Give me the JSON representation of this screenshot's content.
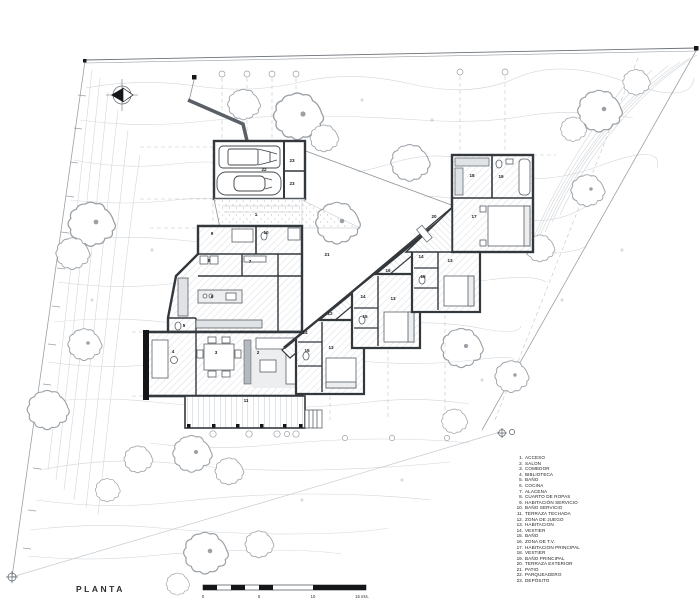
{
  "title": {
    "text": "PLANTA"
  },
  "scale_bar": {
    "tick_labels": [
      "0",
      "5",
      "10",
      "15 mts."
    ]
  },
  "legend": {
    "items": [
      {
        "n": "1.",
        "label": "ACCESO"
      },
      {
        "n": "2.",
        "label": "SALON"
      },
      {
        "n": "3.",
        "label": "COMEDOR"
      },
      {
        "n": "4.",
        "label": "BIBLIOTECA"
      },
      {
        "n": "5.",
        "label": "BAÑO"
      },
      {
        "n": "6.",
        "label": "COCINA"
      },
      {
        "n": "7.",
        "label": "ALACENA"
      },
      {
        "n": "8.",
        "label": "CUARTO DE ROPAS"
      },
      {
        "n": "9.",
        "label": "HABITACIÓN SERVICIO"
      },
      {
        "n": "10.",
        "label": "BAÑO SERVICIO"
      },
      {
        "n": "11.",
        "label": "TERRAZA TECHADA"
      },
      {
        "n": "12.",
        "label": "ZONA DE JUEGO"
      },
      {
        "n": "13.",
        "label": "HABITACION"
      },
      {
        "n": "14.",
        "label": "VESTIER"
      },
      {
        "n": "15.",
        "label": "BAÑO"
      },
      {
        "n": "16.",
        "label": "ZONA DE T.V."
      },
      {
        "n": "17.",
        "label": "HABITACION PRINCIPAL"
      },
      {
        "n": "18.",
        "label": "VESTIER"
      },
      {
        "n": "19.",
        "label": "BAÑO PRINCIPAL"
      },
      {
        "n": "20.",
        "label": "TERRAZA EXTERIOR"
      },
      {
        "n": "21.",
        "label": "PATIO"
      },
      {
        "n": "22.",
        "label": "PARQUEADERO"
      },
      {
        "n": "23.",
        "label": "DEPÓSITO"
      }
    ]
  },
  "plan": {
    "room_labels": [
      {
        "n": "1",
        "x": 256,
        "y": 216
      },
      {
        "n": "2",
        "x": 258,
        "y": 354
      },
      {
        "n": "3",
        "x": 216,
        "y": 354
      },
      {
        "n": "4",
        "x": 173,
        "y": 353
      },
      {
        "n": "5",
        "x": 184,
        "y": 327
      },
      {
        "n": "6",
        "x": 212,
        "y": 298
      },
      {
        "n": "7",
        "x": 250,
        "y": 263
      },
      {
        "n": "8",
        "x": 209,
        "y": 262
      },
      {
        "n": "9",
        "x": 212,
        "y": 235
      },
      {
        "n": "10",
        "x": 266,
        "y": 234
      },
      {
        "n": "11",
        "x": 246,
        "y": 402
      },
      {
        "n": "12",
        "x": 330,
        "y": 315
      },
      {
        "n": "13",
        "x": 331,
        "y": 349
      },
      {
        "n": "13",
        "x": 393,
        "y": 300
      },
      {
        "n": "13",
        "x": 450,
        "y": 262
      },
      {
        "n": "14",
        "x": 305,
        "y": 334
      },
      {
        "n": "14",
        "x": 363,
        "y": 298
      },
      {
        "n": "14",
        "x": 421,
        "y": 258
      },
      {
        "n": "15",
        "x": 307,
        "y": 352
      },
      {
        "n": "15",
        "x": 365,
        "y": 318
      },
      {
        "n": "15",
        "x": 423,
        "y": 278
      },
      {
        "n": "16",
        "x": 388,
        "y": 272
      },
      {
        "n": "17",
        "x": 474,
        "y": 218
      },
      {
        "n": "18",
        "x": 472,
        "y": 177
      },
      {
        "n": "19",
        "x": 501,
        "y": 178
      },
      {
        "n": "20",
        "x": 434,
        "y": 218
      },
      {
        "n": "21",
        "x": 327,
        "y": 256
      },
      {
        "n": "22",
        "x": 264,
        "y": 171
      },
      {
        "n": "23",
        "x": 292,
        "y": 162
      },
      {
        "n": "23",
        "x": 292,
        "y": 185
      }
    ]
  },
  "colors": {
    "wall": "#33383d",
    "thin_line": "#8d9399",
    "contour": "#d2d6da",
    "grid": "#c0c5ca",
    "black": "#141618"
  }
}
